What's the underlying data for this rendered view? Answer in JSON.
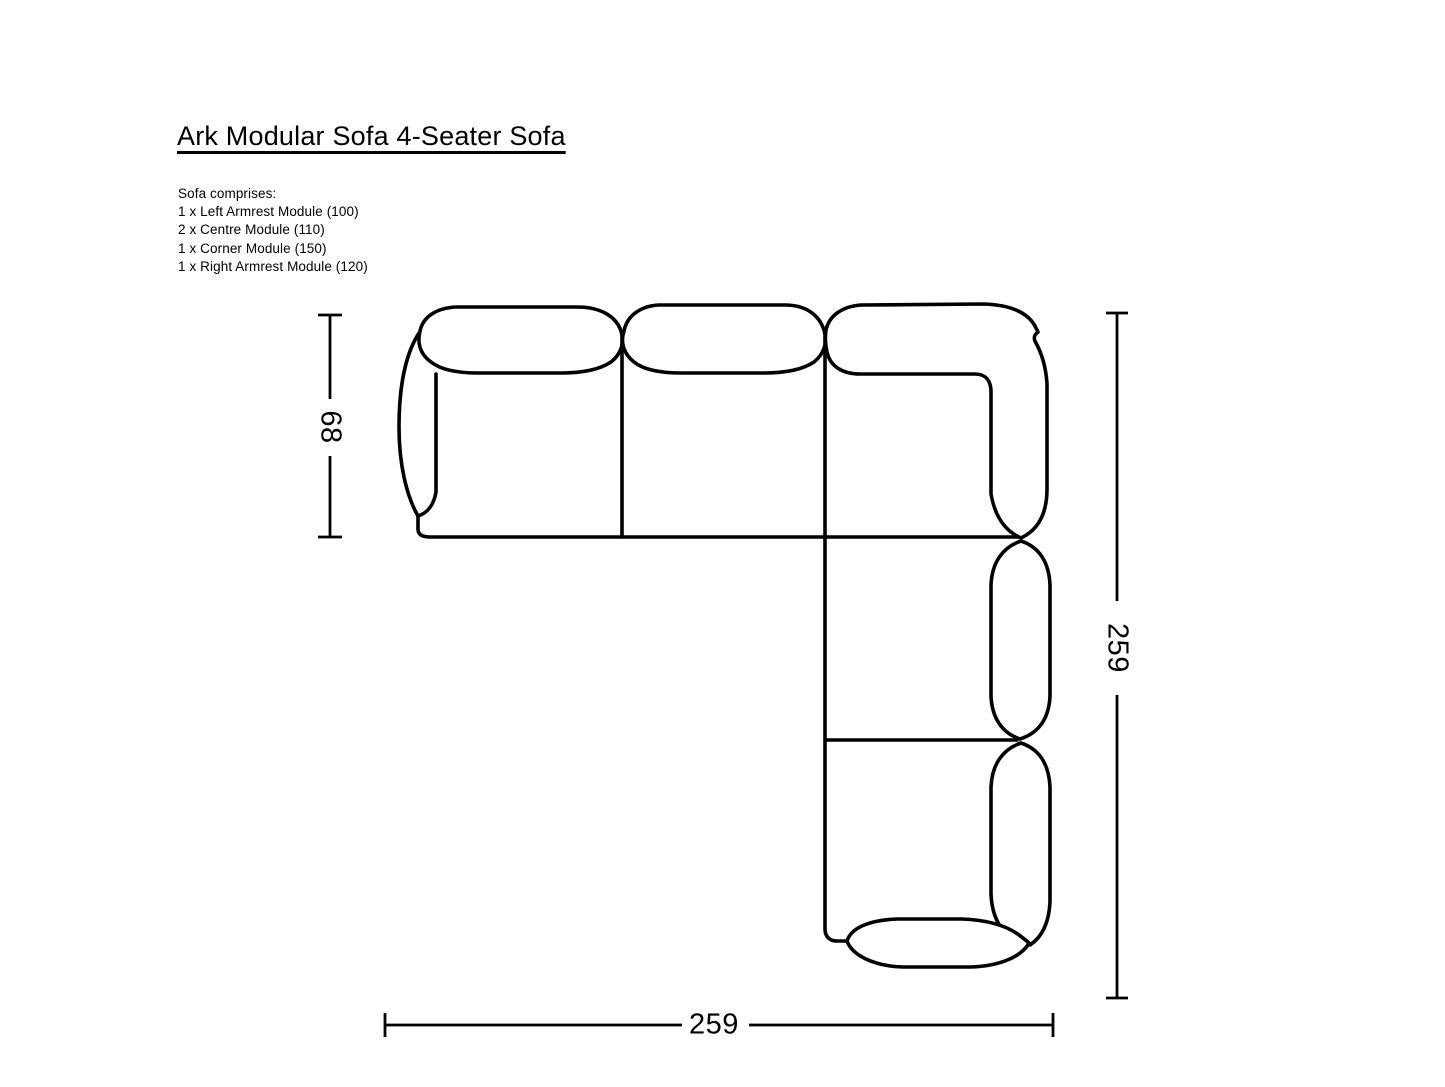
{
  "page": {
    "title": "Ark Modular Sofa 4-Seater Sofa"
  },
  "composition": {
    "heading": "Sofa comprises:",
    "items": [
      "1 x Left Armrest Module (100)",
      "2 x Centre Module (110)",
      "1 x Corner Module (150)",
      "1 x Right Armrest Module (120)"
    ]
  },
  "dimensions": {
    "depth": "68",
    "side_width": "259",
    "bottom_width": "259"
  },
  "colors": {
    "line": "#000000",
    "text": "#000000",
    "background": "#ffffff"
  }
}
